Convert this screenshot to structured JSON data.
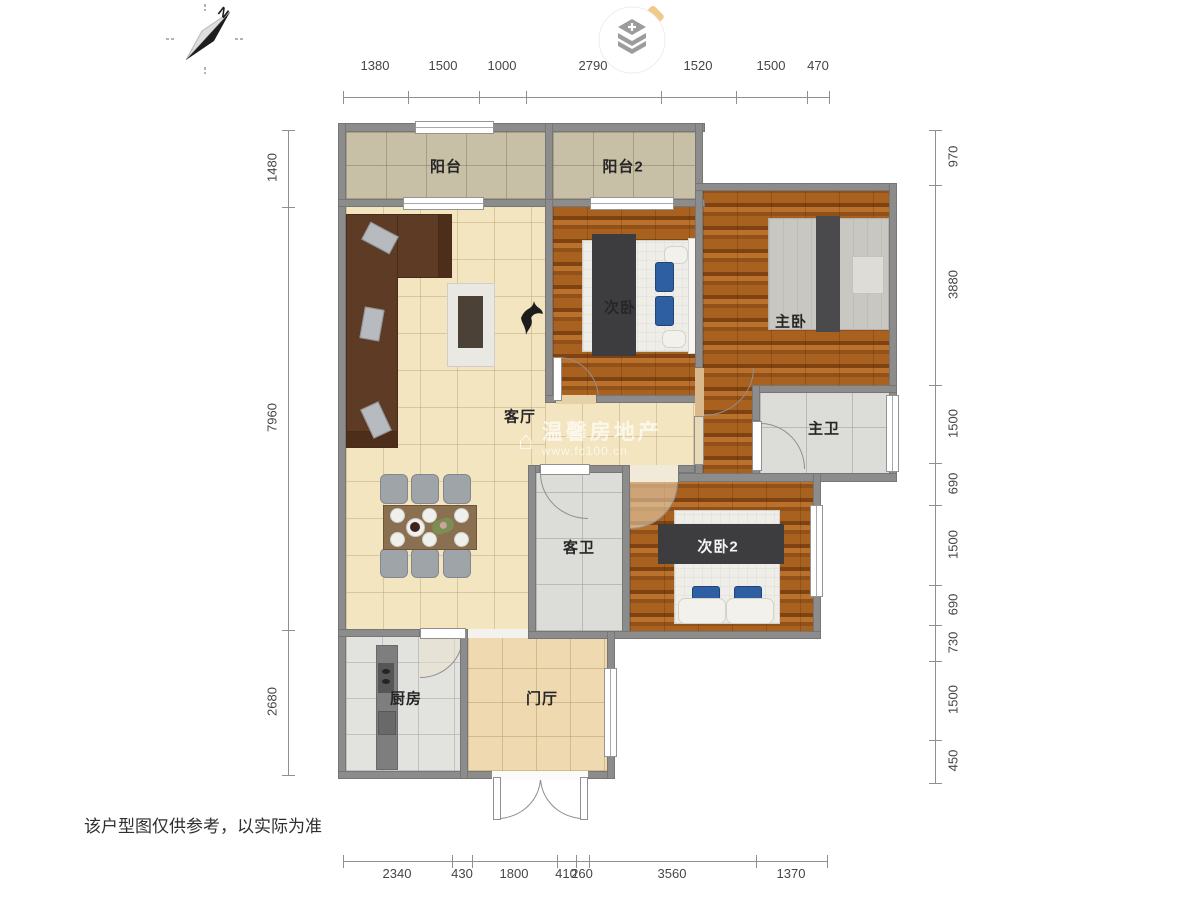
{
  "rooms": {
    "balcony1": "阳台",
    "balcony2": "阳台2",
    "bedroom2": "次卧",
    "master": "主卧",
    "living": "客厅",
    "master_bath": "主卫",
    "guest_bath": "客卫",
    "bedroom3": "次卧2",
    "kitchen": "厨房",
    "foyer": "门厅"
  },
  "dims": {
    "top": [
      "1380",
      "1500",
      "1000",
      "2790",
      "1520",
      "1500",
      "470"
    ],
    "bottom": [
      "2340",
      "430",
      "1800",
      "410",
      "260",
      "3560",
      "1370"
    ],
    "left": [
      "1480",
      "7960",
      "2680"
    ],
    "right": [
      "970",
      "3880",
      "1500",
      "690",
      "1500",
      "690",
      "730",
      "1500",
      "450"
    ]
  },
  "compass": {
    "label": "N"
  },
  "watermark": {
    "icon": "house-icon",
    "line1": "温馨房地产",
    "line2": "www.fc100.cn"
  },
  "disclaimer": "该户型图仅供参考，以实际为准",
  "colors": {
    "wall": "#8c8c8c",
    "wood_floor": "#a8611f",
    "living_floor": "#f4e5c1",
    "balcony_floor": "#c7bfa6",
    "bath_floor": "#dcdcd9",
    "foyer_floor": "#eed9b0",
    "sofa_brown": "#5e3b24",
    "runner_dark": "#3d3d3f",
    "pillow_blue": "#2e5fa3",
    "logo_accent": "#f2c98c"
  }
}
